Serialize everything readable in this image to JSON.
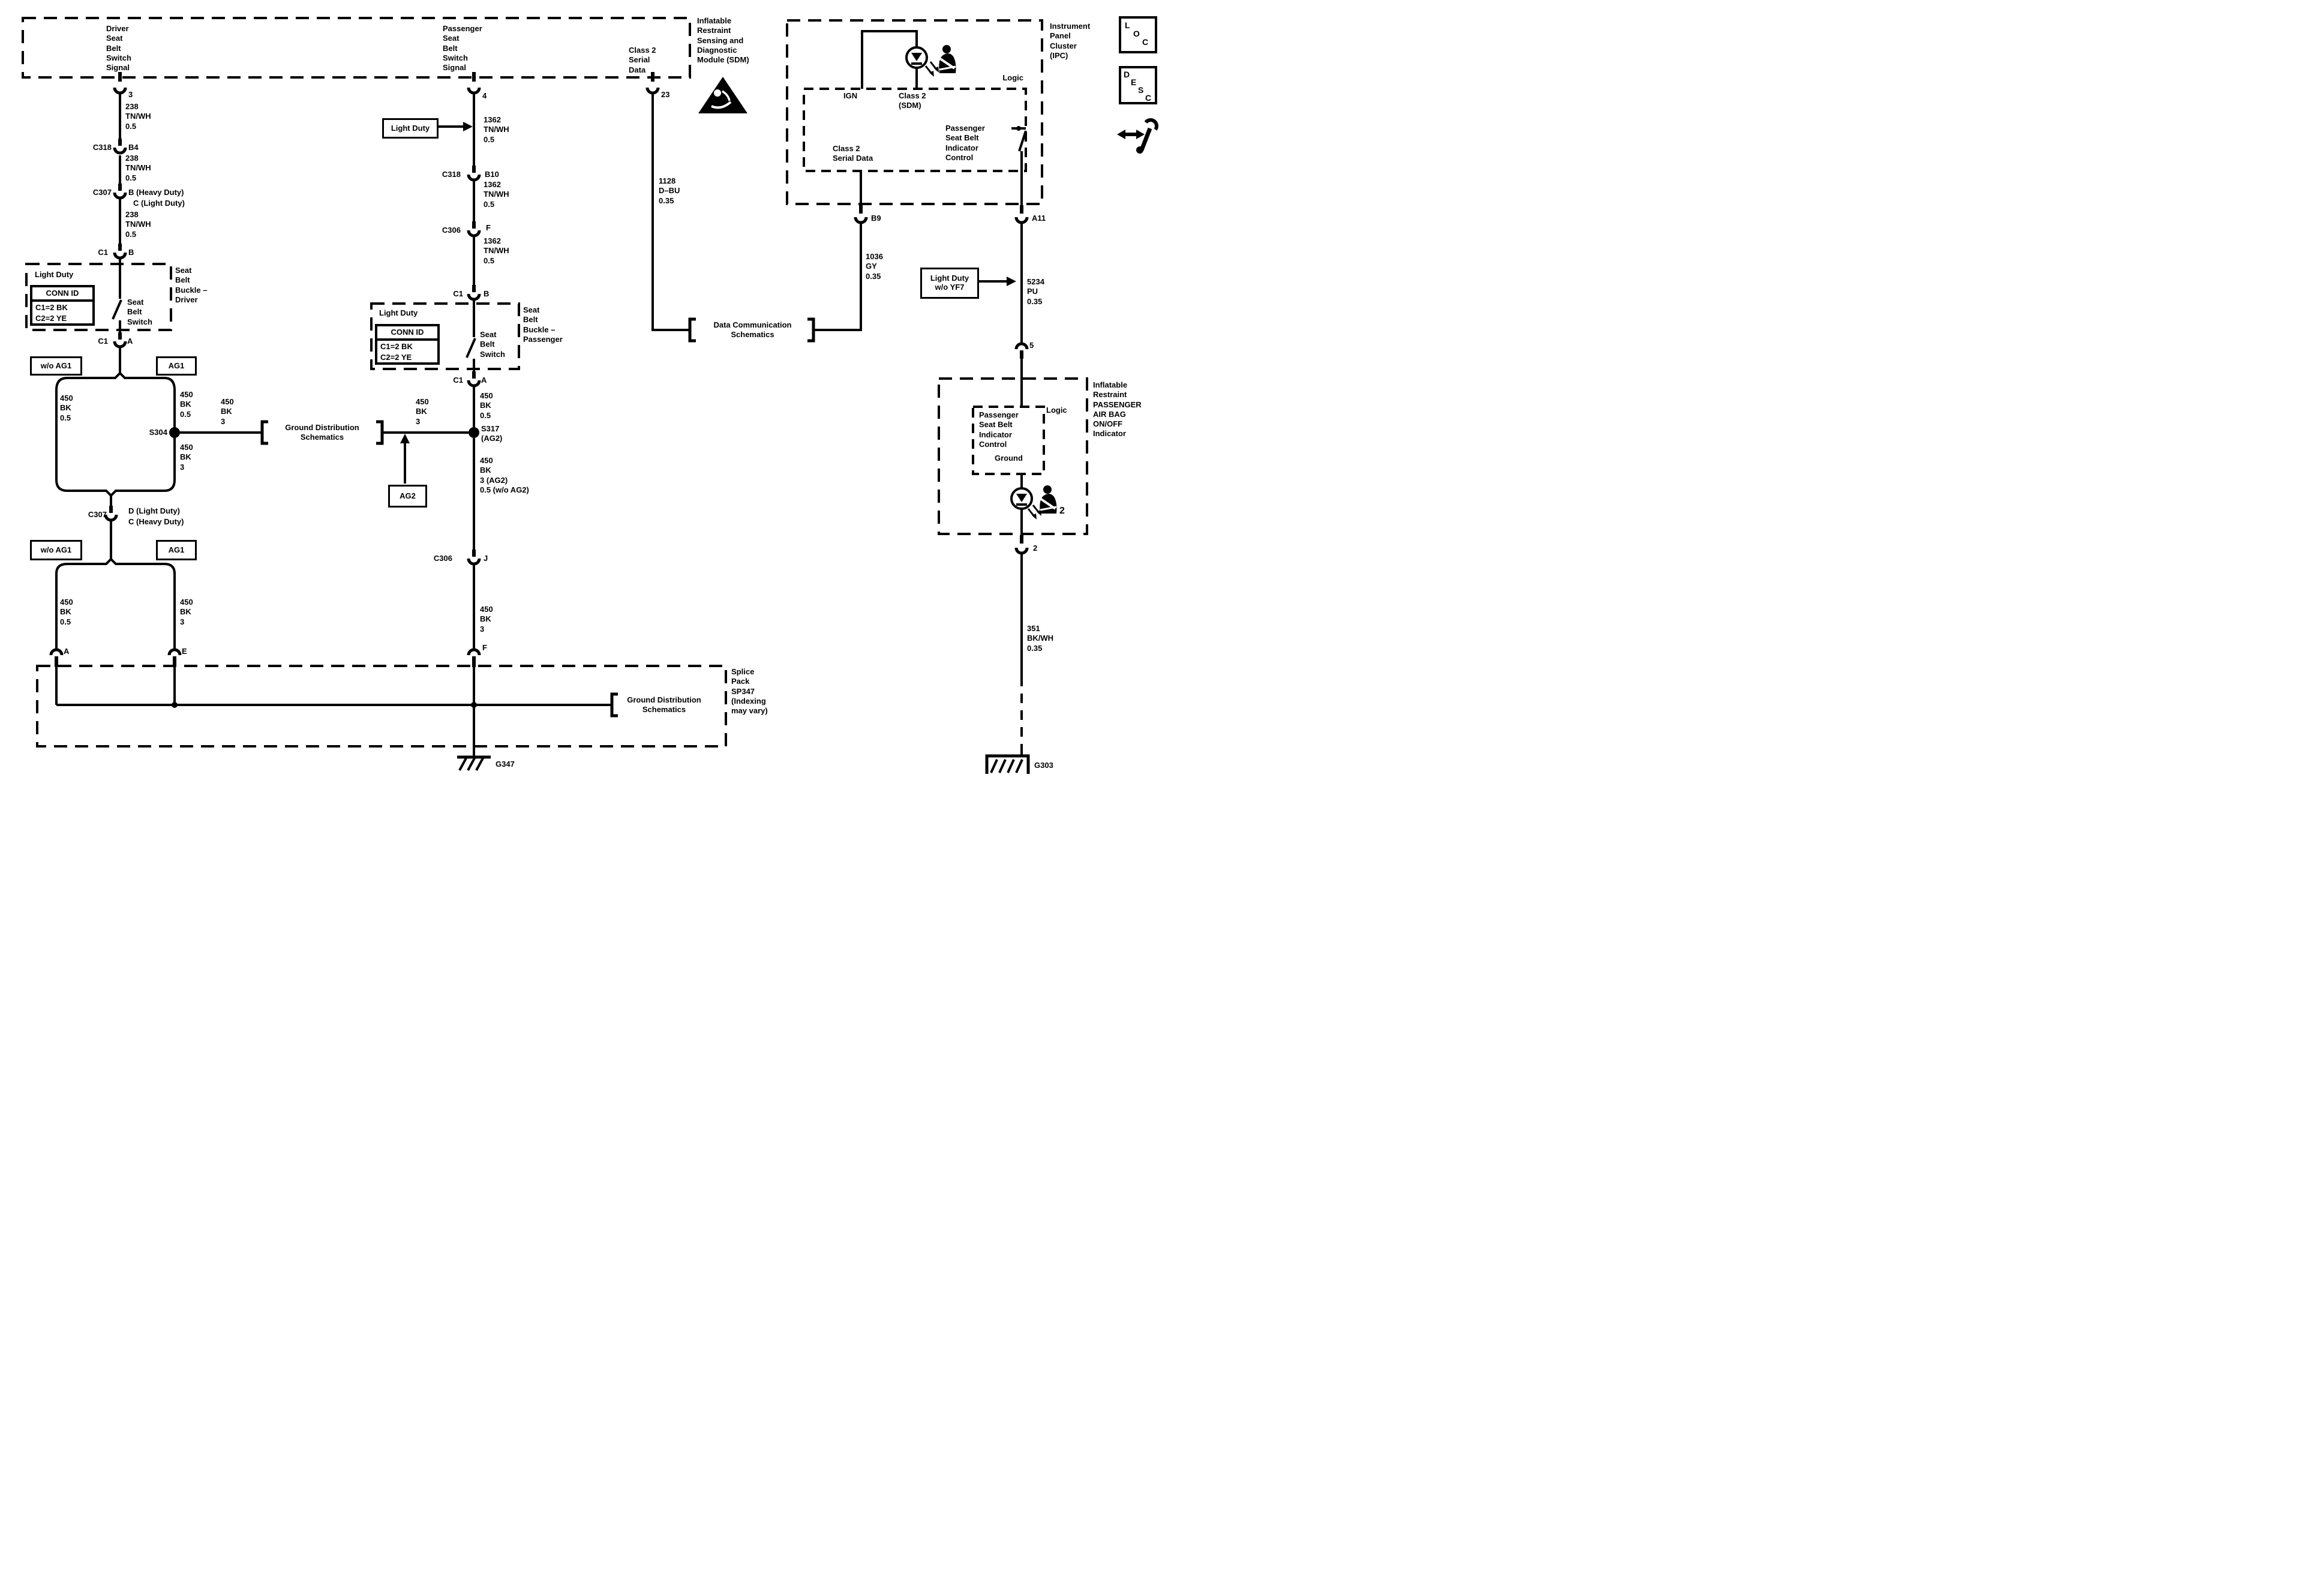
{
  "colors": {
    "ink": "#000000",
    "bg": "#ffffff"
  },
  "wires": {
    "w450_05": "450\nBK\n0.5",
    "w450_3": "450\nBK\n3"
  },
  "gds_label": "Ground Distribution\nSchematics",
  "sdm": {
    "driver_signal": "Driver\nSeat\nBelt\nSwitch\nSignal",
    "passenger_signal": "Passenger\nSeat\nBelt\nSwitch\nSignal",
    "class2_signal": "Class 2\nSerial\nData",
    "module_label": "Inflatable\nRestraint\nSensing and\nDiagnostic\nModule (SDM)",
    "pin_driver": "3",
    "pin_passenger": "4",
    "pin_class2": "23"
  },
  "driver": {
    "wire_238": "238\nTN/WH\n0.5",
    "c318": "C318",
    "c318_pin": "B4",
    "c307": "C307",
    "c307_pin_b": "B (Heavy Duty)",
    "c307_pin_c": "C (Light Duty)",
    "c1": "C1",
    "c1_pin_in": "B",
    "c1_pin_out": "A",
    "buckle": {
      "light_duty": "Light Duty",
      "conn_id": "CONN ID",
      "row1": "C1=2 BK",
      "row2": "C2=2 YE",
      "switch": "Seat\nBelt\nSwitch",
      "label": "Seat\nBelt\nBuckle –\nDriver"
    },
    "wo_ag1": "w/o AG1",
    "ag1": "AG1",
    "s304": "S304",
    "c307_2": "C307",
    "c307_2_pin_d": "D (Light Duty)",
    "c307_2_pin_c": "C (Heavy Duty)",
    "pin_a": "A",
    "pin_e": "E"
  },
  "passenger": {
    "light_duty_tag": "Light Duty",
    "wire_1362": "1362\nTN/WH\n0.5",
    "c318": "C318",
    "c318_pin": "B10",
    "c306": "C306",
    "c306_pin": "F",
    "c1": "C1",
    "c1_pin_in": "B",
    "c1_pin_out": "A",
    "buckle": {
      "light_duty": "Light Duty",
      "conn_id": "CONN ID",
      "row1": "C1=2 BK",
      "row2": "C2=2 YE",
      "switch": "Seat\nBelt\nSwitch",
      "label": "Seat\nBelt\nBuckle –\nPassenger"
    },
    "s317": "S317\n(AG2)",
    "ag2_tag": "AG2",
    "wire_450_mixed": "450\nBK\n3 (AG2)\n0.5 (w/o AG2)",
    "c306_2": "C306",
    "c306_2_pin": "J",
    "pin_f": "F"
  },
  "class2": {
    "wire_1128": "1128\nD–BU\n0.35",
    "dcs": "Data Communication\nSchematics"
  },
  "ipc": {
    "label": "Instrument\nPanel\nCluster\n(IPC)",
    "logic": "Logic",
    "ign": "IGN",
    "class2_sdm": "Class 2\n(SDM)",
    "class2_serial": "Class 2\nSerial Data",
    "control": "Passenger\nSeat Belt\nIndicator\nControl",
    "pin_b9": "B9",
    "pin_a11": "A11"
  },
  "b9": {
    "wire_1036": "1036\nGY\n0.35"
  },
  "a11": {
    "light_duty_tag": "Light Duty\nw/o YF7",
    "wire_5234": "5234\nPU\n0.35",
    "pin_5": "5"
  },
  "indicator": {
    "label": "Inflatable\nRestraint\nPASSENGER\nAIR BAG\nON/OFF\nIndicator",
    "logic": "Logic",
    "control": "Passenger\nSeat Belt\nIndicator\nControl",
    "ground": "Ground",
    "belt_num": "2",
    "pin_2": "2",
    "wire_351": "351\nBK/WH\n0.35",
    "ground_ref": "G303"
  },
  "splice": {
    "label": "Splice\nPack\nSP347\n(Indexing\nmay vary)",
    "ground_ref": "G347"
  },
  "corner": {
    "loc": [
      "L",
      "O",
      "C"
    ],
    "desc": [
      "D",
      "E",
      "S",
      "C"
    ]
  }
}
